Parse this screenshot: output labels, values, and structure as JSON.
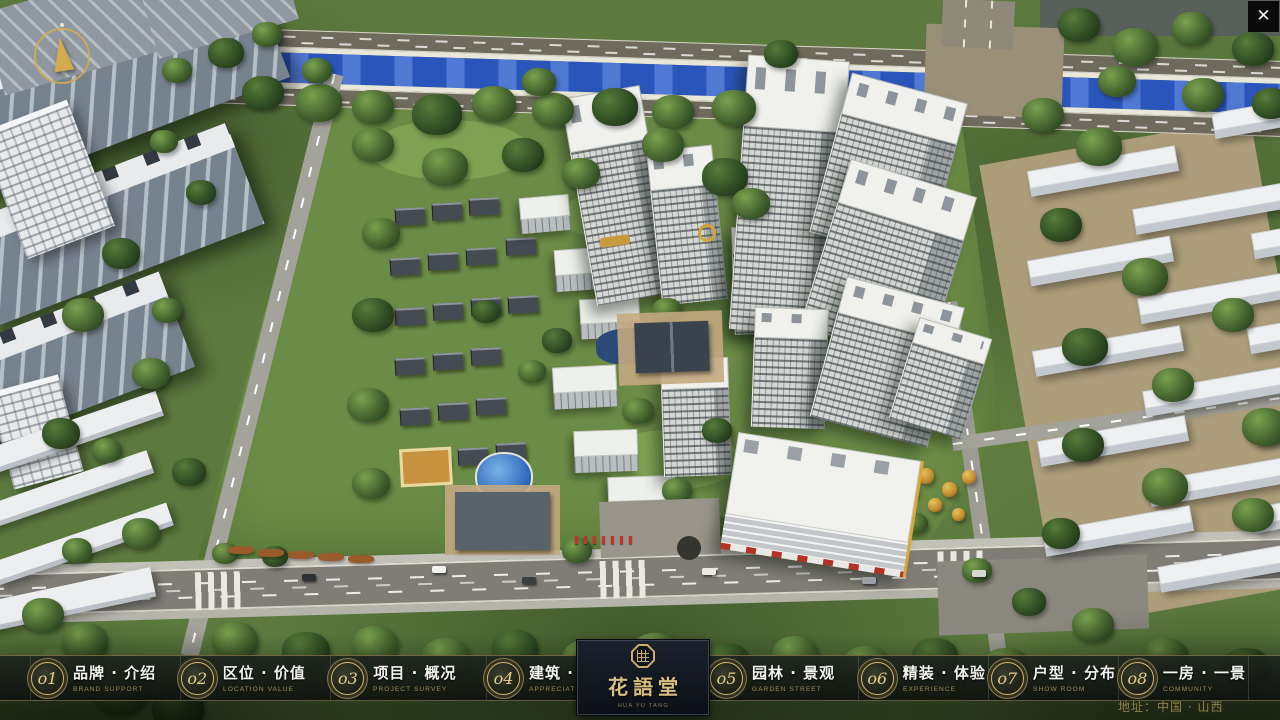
{
  "header": {
    "close_icon": "✕"
  },
  "nav": {
    "items": [
      {
        "num": "o1",
        "zh": "品牌 · 介绍",
        "en": "BRAND SUPPORT"
      },
      {
        "num": "o2",
        "zh": "区位 · 价值",
        "en": "LOCATION VALUE"
      },
      {
        "num": "o3",
        "zh": "项目 · 概况",
        "en": "PROJECT SURVEY"
      },
      {
        "num": "o4",
        "zh": "建筑 · 鉴赏",
        "en": "APPRECIATION"
      },
      {
        "num": "o5",
        "zh": "园林 · 景观",
        "en": "GARDEN STREET"
      },
      {
        "num": "o6",
        "zh": "精装 · 体验",
        "en": "EXPERIENCE"
      },
      {
        "num": "o7",
        "zh": "户型 · 分布",
        "en": "SHOW ROOM"
      },
      {
        "num": "o8",
        "zh": "一房 · 一景",
        "en": "COMMUNITY"
      }
    ]
  },
  "logo": {
    "name": "花語堂",
    "sub": "HUA YU TANG"
  },
  "footer": {
    "address": "地址：中国 · 山西"
  }
}
